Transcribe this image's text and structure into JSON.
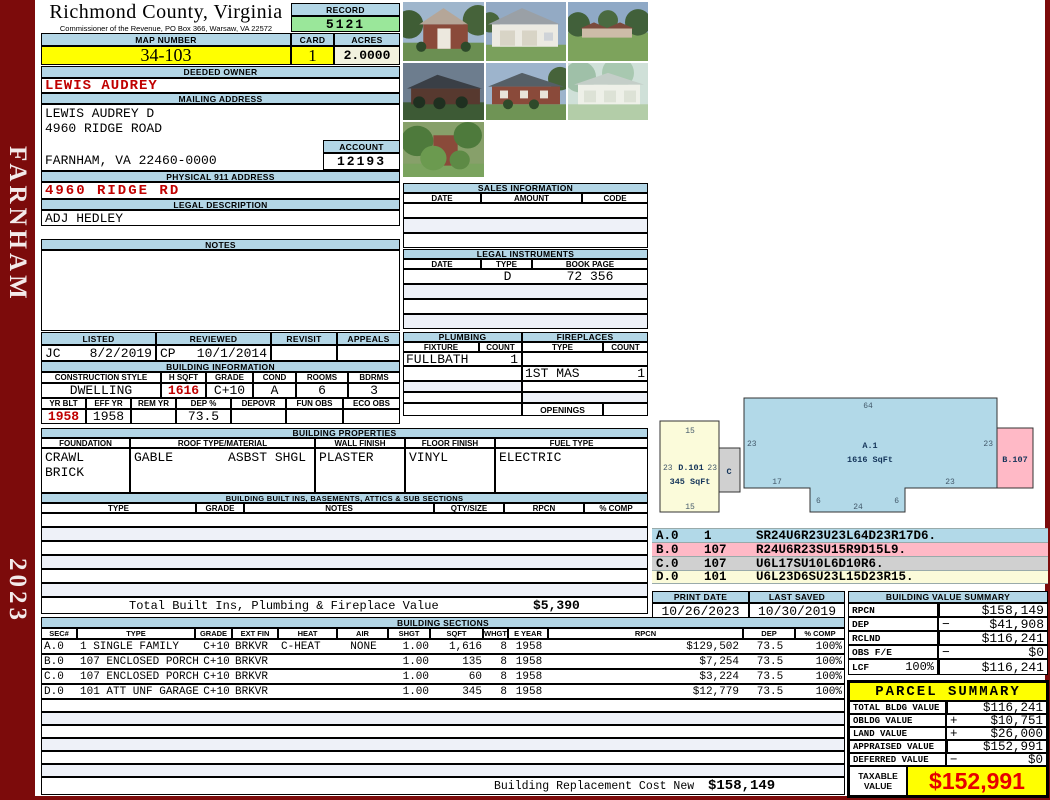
{
  "sidebar": {
    "district": "FARNHAM",
    "year": "2023"
  },
  "header": {
    "county": "Richmond County, Virginia",
    "commissioner": "Commissioner of the Revenue, PO Box 366, Warsaw, VA 22572",
    "record_label": "RECORD",
    "record_number": "5121",
    "map_number_label": "MAP NUMBER",
    "map_number": "34-103",
    "card_label": "CARD",
    "card": "1",
    "acres_label": "ACRES",
    "acres": "2.0000"
  },
  "owner": {
    "deeded_owner_label": "DEEDED OWNER",
    "deeded_owner": "LEWIS AUDREY",
    "mailing_address_label": "MAILING ADDRESS",
    "mailing_name": "LEWIS AUDREY D",
    "mailing_street": "4960 RIDGE ROAD",
    "mailing_city": "FARNHAM, VA 22460-0000",
    "account_label": "ACCOUNT",
    "account_number": "12193",
    "physical_address_label": "PHYSICAL 911 ADDRESS",
    "physical_address": "4960 RIDGE RD",
    "legal_description_label": "LEGAL DESCRIPTION",
    "legal_description": "ADJ HEDLEY",
    "notes_label": "NOTES"
  },
  "sales": {
    "title": "SALES INFORMATION",
    "columns": [
      "DATE",
      "AMOUNT",
      "CODE"
    ]
  },
  "instruments": {
    "title": "LEGAL INSTRUMENTS",
    "columns": [
      "DATE",
      "TYPE",
      "BOOK PAGE"
    ],
    "rows": [
      {
        "date": "",
        "type": "D",
        "book_page": "72 356"
      }
    ]
  },
  "plumbing": {
    "title": "PLUMBING",
    "fixture_label": "FIXTURE",
    "count_label": "COUNT",
    "rows": [
      {
        "fixture": "FULLBATH",
        "count": "1"
      }
    ]
  },
  "fireplaces": {
    "title": "FIREPLACES",
    "type_label": "TYPE",
    "count_label": "COUNT",
    "rows": [
      {
        "type": "1ST MAS",
        "count": "1"
      }
    ],
    "openings_label": "OPENINGS"
  },
  "review": {
    "listed_label": "LISTED",
    "reviewed_label": "REVIEWED",
    "revisit_label": "REVISIT",
    "appeals_label": "APPEALS",
    "listed_by": "JC",
    "listed_date": "8/2/2019",
    "reviewed_by": "CP",
    "reviewed_date": "10/1/2014"
  },
  "building_info": {
    "title": "BUILDING INFORMATION",
    "style_label": "CONSTRUCTION STYLE",
    "hsqft_label": "H SQFT",
    "grade_label": "GRADE",
    "cond_label": "COND",
    "rooms_label": "ROOMS",
    "bdrms_label": "BDRMS",
    "style": "DWELLING",
    "hsqft": "1616",
    "grade": "C+10",
    "cond": "A",
    "rooms": "6",
    "bdrms": "3",
    "yrblt_label": "YR BLT",
    "effyr_label": "EFF YR",
    "remyr_label": "REM YR",
    "dep_label": "DEP %",
    "depovr_label": "DEPOVR",
    "funobs_label": "FUN OBS",
    "ecoobs_label": "ECO OBS",
    "yrblt": "1958",
    "effyr": "1958",
    "dep": "73.5"
  },
  "properties": {
    "title": "BUILDING PROPERTIES",
    "foundation_label": "FOUNDATION",
    "roof_label": "ROOF TYPE/MATERIAL",
    "wall_label": "WALL FINISH",
    "floor_label": "FLOOR FINISH",
    "fuel_label": "FUEL TYPE",
    "foundation_1": "CRAWL",
    "foundation_2": "BRICK",
    "roof_type": "GABLE",
    "roof_material": "ASBST SHGL",
    "wall_finish": "PLASTER",
    "floor_finish": "VINYL",
    "fuel_type": "ELECTRIC"
  },
  "built_ins": {
    "title": "BUILDING BUILT INS, BASEMENTS, ATTICS & SUB SECTIONS",
    "columns": [
      "TYPE",
      "GRADE",
      "NOTES",
      "QTY/SIZE",
      "RPCN",
      "% COMP"
    ],
    "total_label": "Total Built Ins, Plumbing & Fireplace Value",
    "total_value": "$5,390"
  },
  "print_info": {
    "print_date_label": "PRINT DATE",
    "print_date": "10/26/2023",
    "last_saved_label": "LAST SAVED",
    "last_saved": "10/30/2019"
  },
  "value_summary": {
    "title": "BUILDING VALUE SUMMARY",
    "rows": [
      {
        "label": "RPCN",
        "sign": "",
        "value": "$158,149"
      },
      {
        "label": "DEP",
        "sign": "−",
        "value": "$41,908"
      },
      {
        "label": "RCLND",
        "sign": "",
        "value": "$116,241"
      },
      {
        "label": "OBS F/E",
        "sign": "−",
        "value": "$0"
      },
      {
        "label": "LCF",
        "pct": "100%",
        "sign": "",
        "value": "$116,241"
      }
    ]
  },
  "sketch": {
    "a_name": "A.1",
    "a_sqft": "1616 SqFt",
    "b_name": "B.107",
    "c_name": "C",
    "d_name": "D.101",
    "d_sqft": "345 SqFt",
    "dims": {
      "a_top": "64",
      "a_left": "23",
      "a_right": "23",
      "a_bottom_left": "17",
      "a_bottom_right": "23",
      "notch_left": "6",
      "notch_bottom": "24",
      "notch_right": "6",
      "d_top": "15",
      "d_left": "23",
      "d_right": "23",
      "d_bottom": "15"
    },
    "legend": [
      {
        "sec": "A.0",
        "code": "1",
        "trace": "SR24U6R23U23L64D23R17D6."
      },
      {
        "sec": "B.0",
        "code": "107",
        "trace": "R24U6R23SU15R9D15L9."
      },
      {
        "sec": "C.0",
        "code": "107",
        "trace": "U6L17SU10L6D10R6."
      },
      {
        "sec": "D.0",
        "code": "101",
        "trace": "U6L23D6SU23L15D23R15."
      }
    ]
  },
  "sections": {
    "title": "BUILDING SECTIONS",
    "columns": [
      "SEC#",
      "TYPE",
      "GRADE",
      "EXT FIN",
      "HEAT",
      "AIR",
      "SHGT",
      "SQFT",
      "WHGT",
      "E YEAR",
      "RPCN",
      "DEP",
      "% COMP"
    ],
    "rows": [
      {
        "sec": "A.0",
        "type": "1 SINGLE FAMILY",
        "grade": "C+10",
        "ext_fin": "BRKVR",
        "heat": "C-HEAT",
        "air": "NONE",
        "shgt": "1.00",
        "sqft": "1,616",
        "whgt": "8",
        "eyear": "1958",
        "rpcn": "$129,502",
        "dep": "73.5",
        "comp": "100%"
      },
      {
        "sec": "B.0",
        "type": "107 ENCLOSED PORCH",
        "grade": "C+10",
        "ext_fin": "BRKVR",
        "heat": "",
        "air": "",
        "shgt": "1.00",
        "sqft": "135",
        "whgt": "8",
        "eyear": "1958",
        "rpcn": "$7,254",
        "dep": "73.5",
        "comp": "100%"
      },
      {
        "sec": "C.0",
        "type": "107 ENCLOSED PORCH",
        "grade": "C+10",
        "ext_fin": "BRKVR",
        "heat": "",
        "air": "",
        "shgt": "1.00",
        "sqft": "60",
        "whgt": "8",
        "eyear": "1958",
        "rpcn": "$3,224",
        "dep": "73.5",
        "comp": "100%"
      },
      {
        "sec": "D.0",
        "type": "101 ATT UNF GARAGE",
        "grade": "C+10",
        "ext_fin": "BRKVR",
        "heat": "",
        "air": "",
        "shgt": "1.00",
        "sqft": "345",
        "whgt": "8",
        "eyear": "1958",
        "rpcn": "$12,779",
        "dep": "73.5",
        "comp": "100%"
      }
    ],
    "replacement_label": "Building Replacement Cost New",
    "replacement_value": "$158,149"
  },
  "parcel_summary": {
    "title": "PARCEL SUMMARY",
    "rows": [
      {
        "label": "TOTAL BLDG VALUE",
        "sign": "",
        "value": "$116,241"
      },
      {
        "label": "OBLDG VALUE",
        "sign": "+",
        "value": "$10,751"
      },
      {
        "label": "LAND VALUE",
        "sign": "+",
        "value": "$26,000"
      },
      {
        "label": "APPRAISED VALUE",
        "sign": "",
        "value": "$152,991"
      },
      {
        "label": "DEFERRED VALUE",
        "sign": "−",
        "value": "$0"
      }
    ],
    "taxable_label": "TAXABLE VALUE",
    "taxable_value": "$152,991"
  },
  "colors": {
    "accent_maroon": "#7c0b0b",
    "header_blue": "#b3d6e6",
    "highlight_yellow": "#ffff00",
    "record_green": "#9ae79a",
    "acres_cream": "#f2f2de",
    "value_red": "#c00000",
    "taxable_red": "#e60000",
    "sketch_blue": "#b2d9e8",
    "sketch_pink": "#ffb9c6",
    "sketch_grey": "#d0d0d0",
    "sketch_cream": "#fbfbda"
  }
}
